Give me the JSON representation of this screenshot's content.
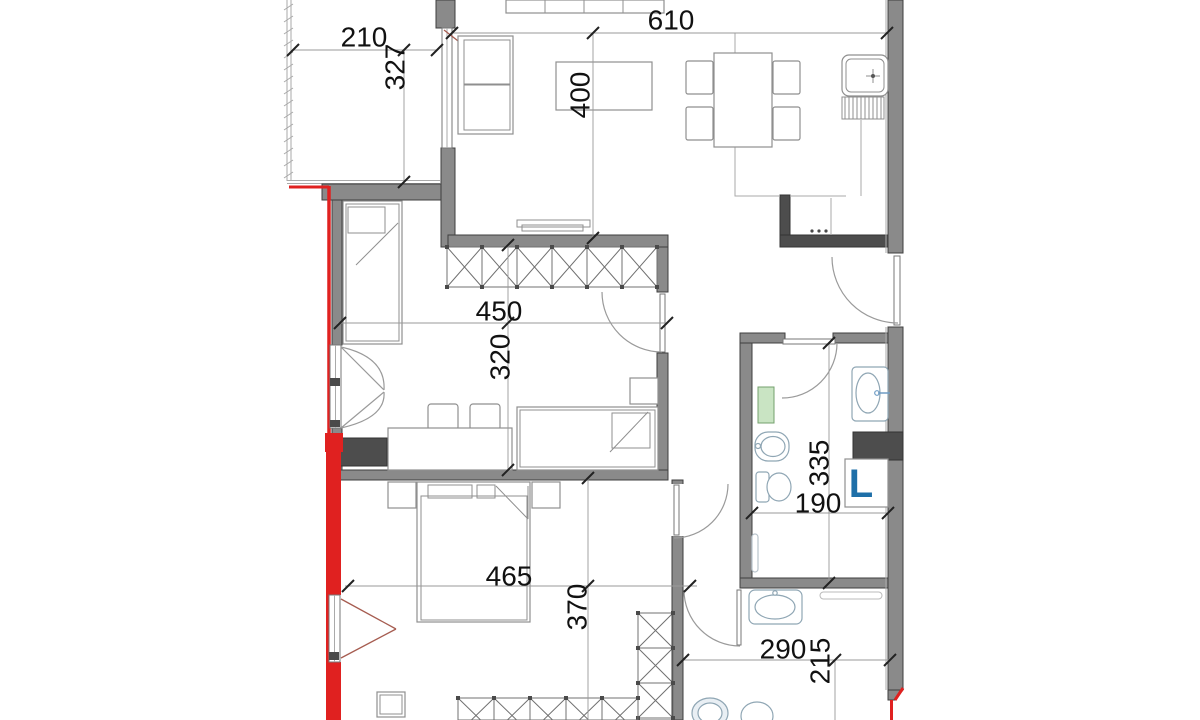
{
  "colors": {
    "wall": "#8a8a8a",
    "wall_dark": "#4d4d4d",
    "accent_red": "#e02120",
    "swing_maroon": "#a65c50",
    "radiator_green": "#c9e4c3",
    "fixture": "#8fa6b4",
    "laundry_blue": "#1e6fa8",
    "dim_text": "#111111"
  },
  "dimensions": {
    "balcony_width": "210",
    "balcony_depth": "327",
    "living_width": "610",
    "living_depth": "400",
    "bedroom1_width": "450",
    "bedroom1_depth": "320",
    "bedroom2_width": "465",
    "bedroom2_depth": "370",
    "bathroom1_depth": "335",
    "bathroom1_width": "190",
    "bathroom2_width": "290",
    "bathroom2_depth": "215"
  },
  "labels": {
    "washing_machine": "L"
  }
}
